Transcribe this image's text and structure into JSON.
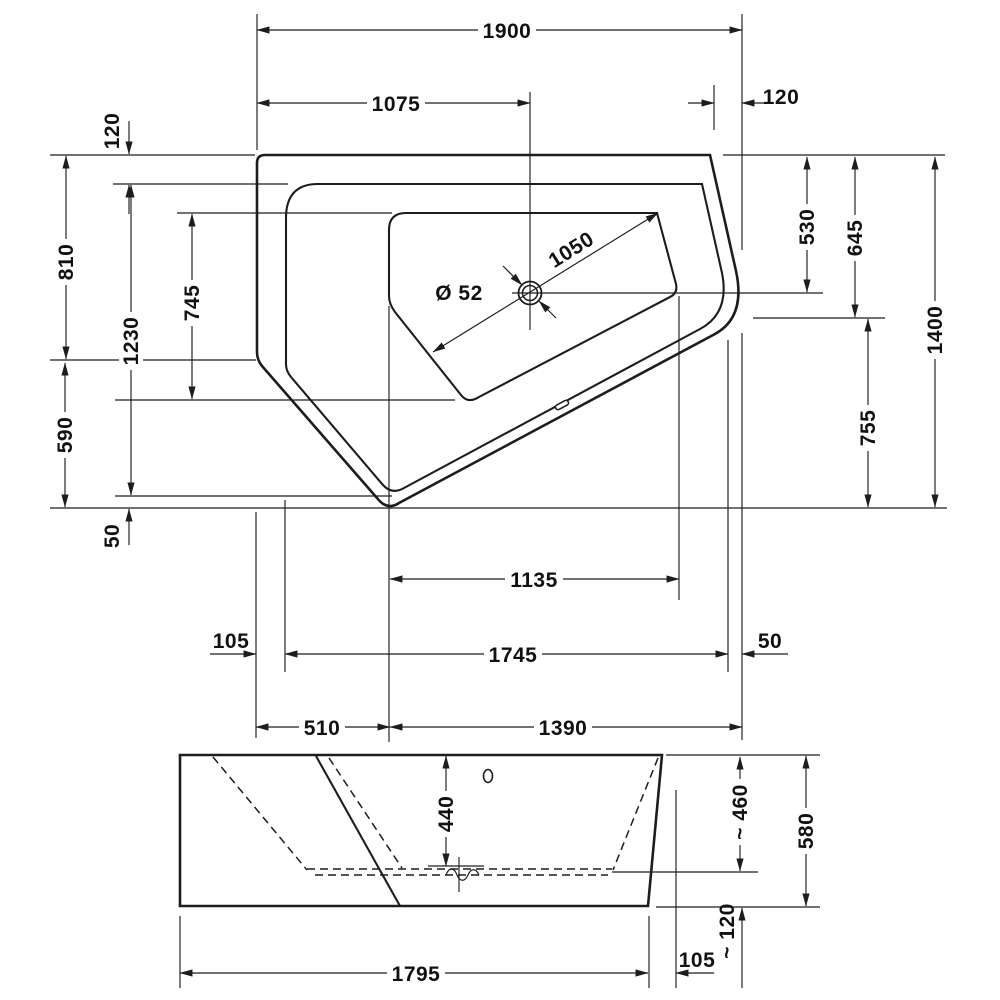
{
  "colors": {
    "background": "#ffffff",
    "line": "#1d1d1d"
  },
  "plan": {
    "dims": {
      "overall_width": "1900",
      "drain_offset_x": "1075",
      "corner_cut_width": "120",
      "rim_top_width": "120",
      "left_height_upper": "810",
      "inner_rim_height": "1230",
      "basin_height": "745",
      "left_height_lower": "590",
      "rim_bottom_offset": "50",
      "drain_offset_y": "530",
      "right_upper": "645",
      "right_lower": "755",
      "overall_height": "1400",
      "basin_diagonal": "1050",
      "drain_diameter": "Ø 52",
      "bottom_basin_width": "1135",
      "rim_left_width": "105",
      "inner_rim_width": "1745",
      "rim_right_width": "50",
      "bottom_left_width": "510",
      "bottom_right_width": "1390"
    }
  },
  "elevation": {
    "dims": {
      "depth_at_drain": "440",
      "inner_height": "~ 460",
      "overall_height": "580",
      "feet_height": "~ 120",
      "right_offset": "105",
      "overall_width": "1795"
    }
  }
}
